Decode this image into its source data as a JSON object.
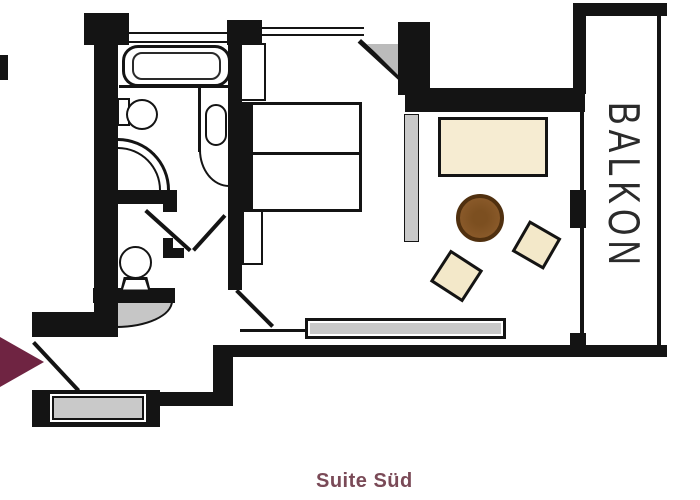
{
  "labels": {
    "balcony": "BALKON",
    "caption": "Suite Süd"
  },
  "colors": {
    "wall": "#141414",
    "entrance_arrow": "#6f2442",
    "caption_text": "#7a4a57",
    "balcony_text": "#2b2b2b",
    "sofa_fill": "#f6ecd2",
    "stool_fill": "#f3e8c9",
    "table_fill": "#8a5a2a",
    "table_border": "#50300f",
    "gray_furniture_fill": "#c9c9c9",
    "diagonal_wall_triangle": "#bbbbbb"
  },
  "legend": {
    "furniture_icons": [
      "bathtub",
      "washbasin",
      "vanity-basin",
      "shower",
      "toilet",
      "double-bed",
      "nightstand",
      "wardrobe",
      "sofa",
      "coffee-table",
      "stool",
      "radiator",
      "sideboard",
      "entrance-arrow",
      "door-swing"
    ]
  }
}
